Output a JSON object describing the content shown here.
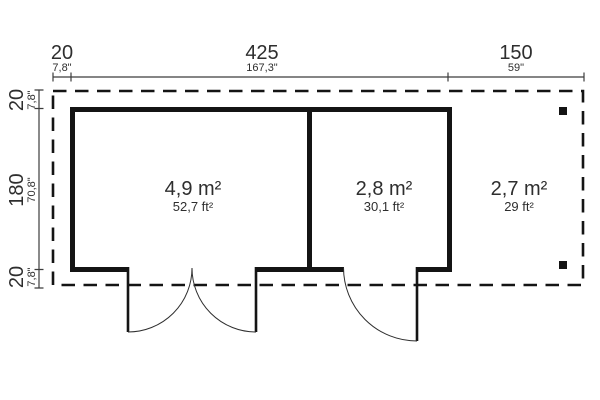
{
  "drawing": {
    "type": "floor-plan",
    "colors": {
      "wall": "#141414",
      "dashed_outline": "#141414",
      "dimension_line": "#3c3c3c",
      "text": "#2e2e2e",
      "background": "#ffffff"
    }
  },
  "dimensions": {
    "top": [
      {
        "cm": "20",
        "inch": "7,8\""
      },
      {
        "cm": "425",
        "inch": "167,3\""
      },
      {
        "cm": "150",
        "inch": "59\""
      }
    ],
    "left": [
      {
        "cm": "20",
        "inch": "7,8\""
      },
      {
        "cm": "180",
        "inch": "70,8\""
      },
      {
        "cm": "20",
        "inch": "7,8\""
      }
    ]
  },
  "rooms": [
    {
      "id": "room-1",
      "area_m2": "4,9 m²",
      "area_ft2": "52,7 ft²"
    },
    {
      "id": "room-2",
      "area_m2": "2,8 m²",
      "area_ft2": "30,1 ft²"
    },
    {
      "id": "terrace",
      "area_m2": "2,7 m²",
      "area_ft2": "29 ft²"
    }
  ]
}
